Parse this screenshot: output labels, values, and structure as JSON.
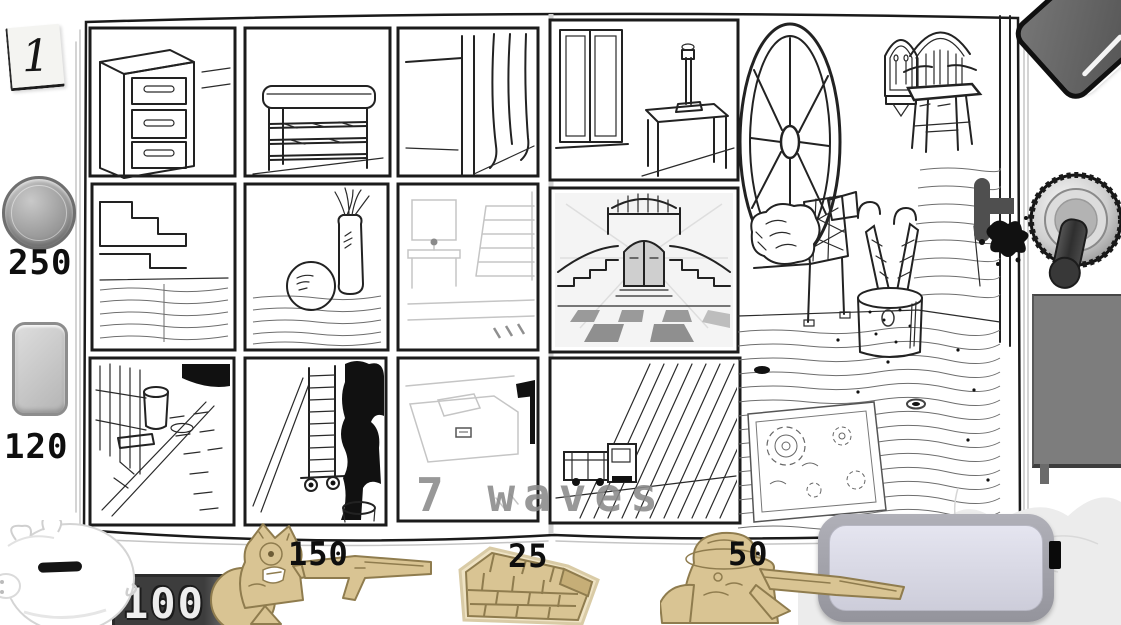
{
  "level": {
    "badge": "1"
  },
  "wave": {
    "banner": "7 waves"
  },
  "bank": {
    "balance": "100"
  },
  "tools": {
    "coin": {
      "id": "coin",
      "price": "250"
    },
    "eraser": {
      "id": "eraser",
      "price": "120"
    }
  },
  "shop": {
    "items": [
      {
        "id": "cat-soldier",
        "price": "150"
      },
      {
        "id": "brick-wall",
        "price": "25"
      },
      {
        "id": "scout-soldier",
        "price": "50"
      }
    ]
  },
  "board": {
    "pages": [
      {
        "side": "left",
        "panels": [
          "dresser-hallway",
          "shoe-bench",
          "doorway-curtain",
          "staircase-corner",
          "vases-on-floor",
          "faded-hallway",
          "alley-fence",
          "alley-cart-inkblot",
          "faded-bedroom"
        ]
      },
      {
        "side": "right",
        "panels": [
          "window-side-table",
          "grand-staircase-entrance",
          "truck-at-shutter"
        ],
        "art": [
          "wagon-wheel",
          "wall-sconce",
          "windsor-chair",
          "crib-bench",
          "umbrella-stand",
          "plank-floor",
          "ornate-rug",
          "door-handle",
          "ink-splatter"
        ]
      }
    ]
  },
  "icons": [
    "sticky-note-icon",
    "coin-icon",
    "eraser-icon",
    "piggy-bank-icon",
    "cat-soldier-icon",
    "brick-wall-icon",
    "scout-soldier-icon",
    "battery-icon",
    "toggle-switch-icon",
    "metal-plate-icon",
    "dark-eraser-icon",
    "cloth-icon"
  ],
  "colors": {
    "cardboard": "#d9c493",
    "cardboard_line": "#8f7c4e",
    "money_display_dark": "#3d3d3d",
    "money_display_light": "#989898",
    "wave_text": "#8a8a8a",
    "battery_fill": "#dedeea",
    "battery_frame": "#a2a2aa",
    "plate": "#7d7d7d",
    "ink": "#111111"
  }
}
